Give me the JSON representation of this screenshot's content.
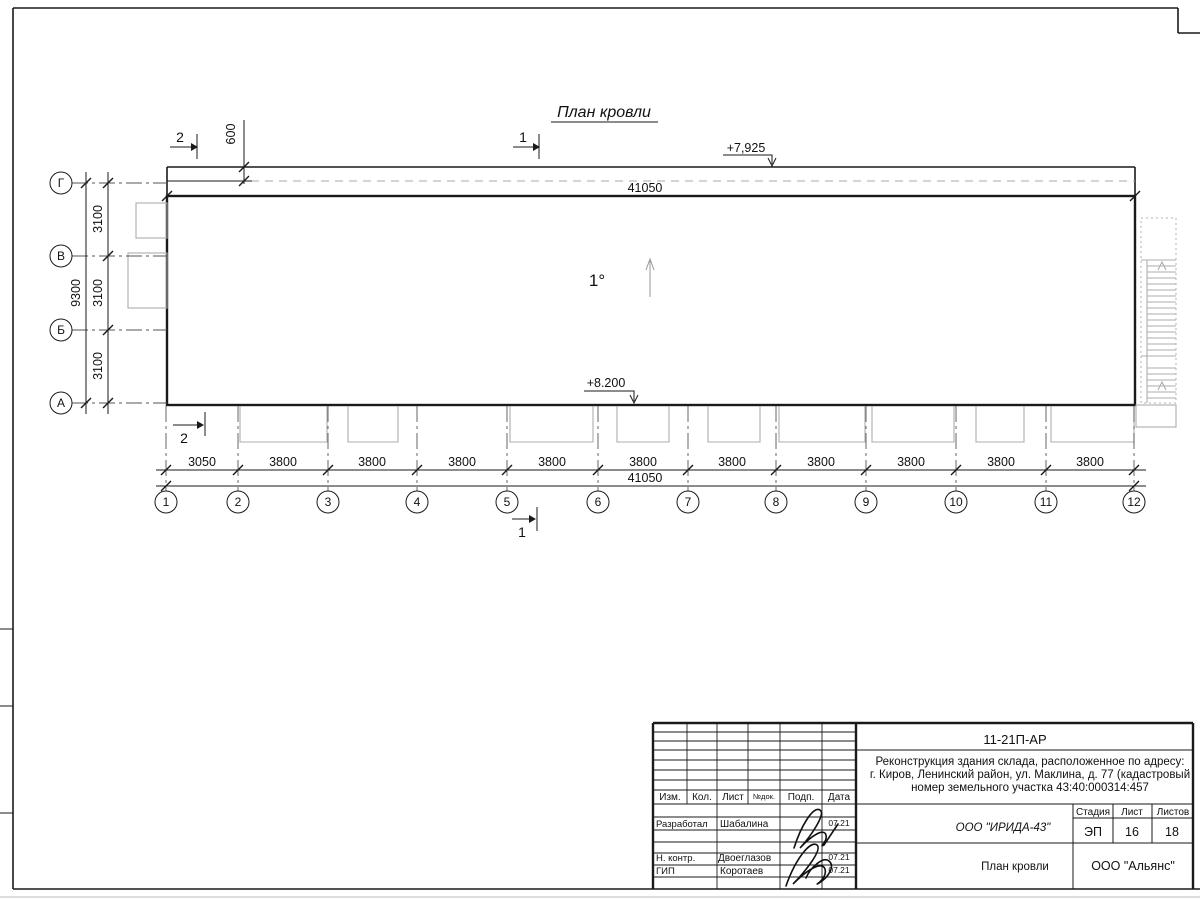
{
  "plan": {
    "title": "План кровли",
    "slope_label": "1°",
    "elevation_top": "+7,925",
    "elevation_bottom": "+8.200",
    "parapet_dim": "600",
    "overall_top": "41050",
    "overall_bottom": "41050",
    "overall_left": "9300",
    "left_bays": [
      "3100",
      "3100",
      "3100"
    ],
    "bottom_bays": [
      "3050",
      "3800",
      "3800",
      "3800",
      "3800",
      "3800",
      "3800",
      "3800",
      "3800",
      "3800",
      "3800"
    ],
    "row_axes": [
      "Г",
      "В",
      "Б",
      "А"
    ],
    "column_axes": [
      "1",
      "2",
      "3",
      "4",
      "5",
      "6",
      "7",
      "8",
      "9",
      "10",
      "11",
      "12"
    ],
    "section_mark_1": "1",
    "section_mark_2": "2"
  },
  "title_block": {
    "doc_number": "11-21П-АР",
    "description_lines": [
      "Реконструкция здания склада, расположенное по адресу:",
      "г. Киров, Ленинский район, ул. Маклина, д. 77 (кадастровый",
      "номер земельного участка 43:40:000314:457"
    ],
    "header": {
      "izm": "Изм.",
      "kol": "Кол.",
      "list": "Лист",
      "doc": "№док.",
      "podp": "Подп.",
      "data": "Дата"
    },
    "stage_header": {
      "stage": "Стадия",
      "sheet": "Лист",
      "sheets": "Листов"
    },
    "stage": "ЭП",
    "sheet": "16",
    "sheets": "18",
    "designer_company": "ООО \"ИРИДА-43\"",
    "sheet_title": "План кровли",
    "org": "ООО \"Альянс\"",
    "signatures": [
      {
        "role": "Разработал",
        "name": "Шабалина",
        "date": "07.21"
      },
      {
        "role": "Н. контр.",
        "name": "Двоеглазов",
        "date": "07.21"
      },
      {
        "role": "ГИП",
        "name": "Коротаев",
        "date": "07.21"
      }
    ]
  }
}
